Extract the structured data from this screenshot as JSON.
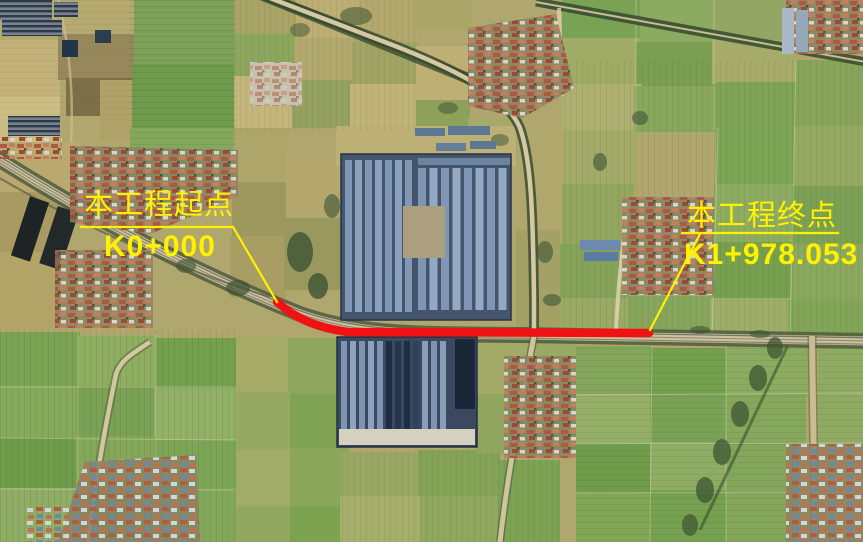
{
  "figure": {
    "colors": {
      "route_red": "#f01212",
      "annotation_yellow": "#fff100"
    }
  },
  "route": {
    "path_d": "M 277,302 C 294,317 313,327 348,332 L 649,333",
    "color": "#f01212"
  },
  "annotations": {
    "start": {
      "title": "本工程起点",
      "station": "K0+000",
      "underline_points": "81,227 233,227",
      "leader_points": "233,227 277,302"
    },
    "end": {
      "title": "本工程终点",
      "station": "K1+978.053",
      "underline_points": "682,233 838,233",
      "leader_points": "700,234 650,330"
    }
  }
}
